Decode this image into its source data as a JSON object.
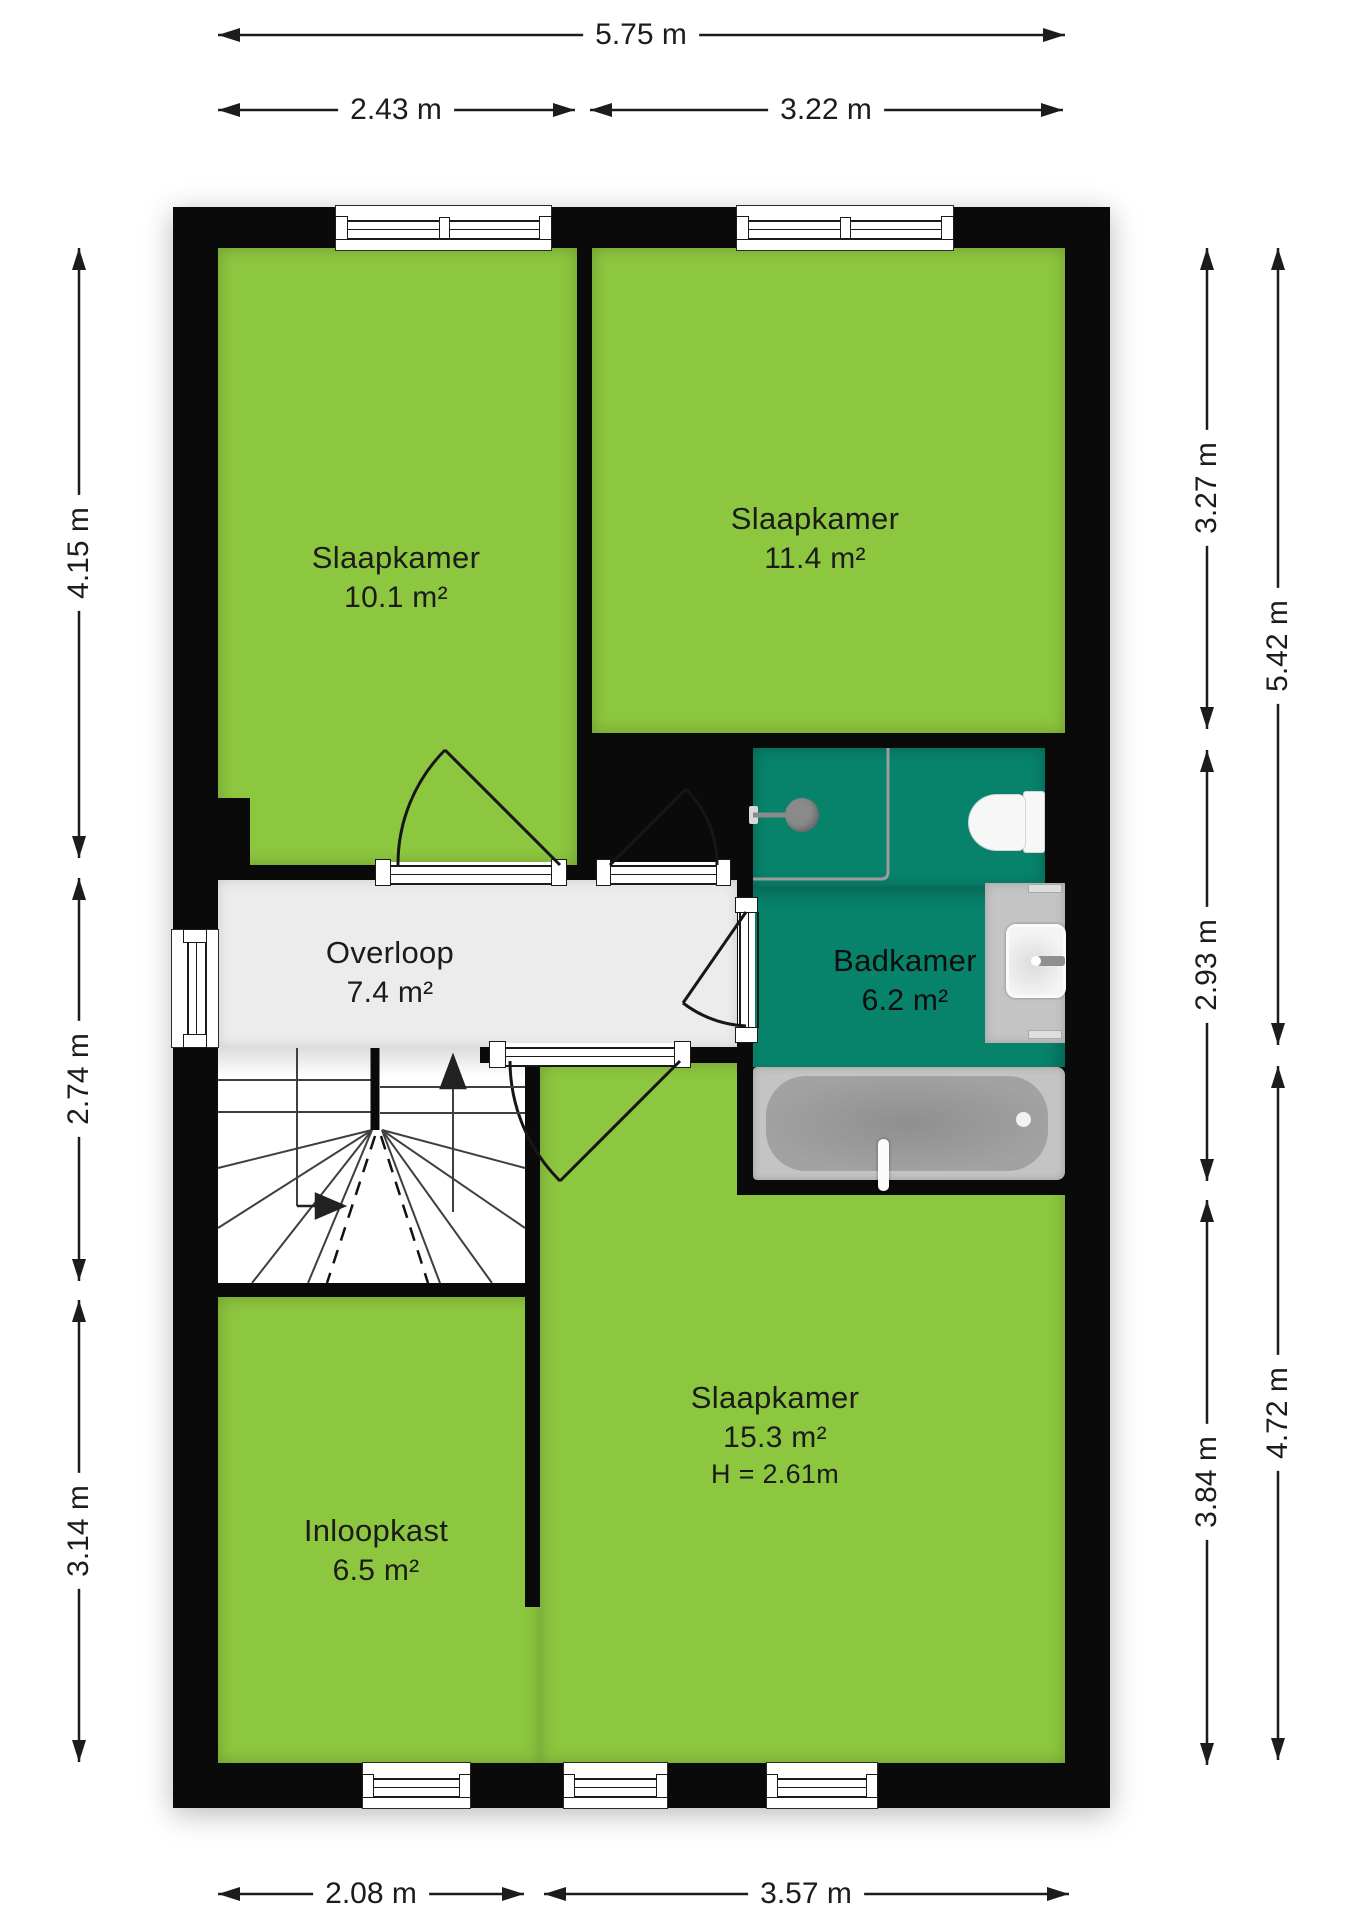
{
  "floorplan": {
    "type": "residential-floor-plan",
    "language": "nl",
    "rooms": [
      {
        "id": "slaapkamer-1",
        "name": "Slaapkamer",
        "area": "10.1 m²"
      },
      {
        "id": "slaapkamer-2",
        "name": "Slaapkamer",
        "area": "11.4 m²"
      },
      {
        "id": "overloop",
        "name": "Overloop",
        "area": "7.4 m²"
      },
      {
        "id": "badkamer",
        "name": "Badkamer",
        "area": "6.2 m²"
      },
      {
        "id": "slaapkamer-3",
        "name": "Slaapkamer",
        "area": "15.3 m²",
        "height": "H = 2.61m"
      },
      {
        "id": "inloopkast",
        "name": "Inloopkast",
        "area": "6.5 m²"
      }
    ],
    "dimensions": {
      "top_total": "5.75 m",
      "top_left": "2.43 m",
      "top_right": "3.22 m",
      "left_top": "4.15 m",
      "left_middle": "2.74 m",
      "left_bottom": "3.14 m",
      "right_inner_top": "3.27 m",
      "right_inner_middle": "2.93 m",
      "right_inner_bottom": "3.84 m",
      "right_outer_top": "5.42 m",
      "right_outer_bottom": "4.72 m",
      "bottom_left": "2.08 m",
      "bottom_right": "3.57 m"
    },
    "fixtures": [
      "shower-head",
      "toilet",
      "sink-vanity",
      "bathtub",
      "staircase"
    ],
    "colors": {
      "wall": "#0a0a0a",
      "room_green": "#8dc63f",
      "bathroom_teal": "#07826b",
      "hall_gray": "#ececec",
      "fixture_gray": "#c4c4c4",
      "tub_inner_gray": "#a2a2a2"
    }
  }
}
